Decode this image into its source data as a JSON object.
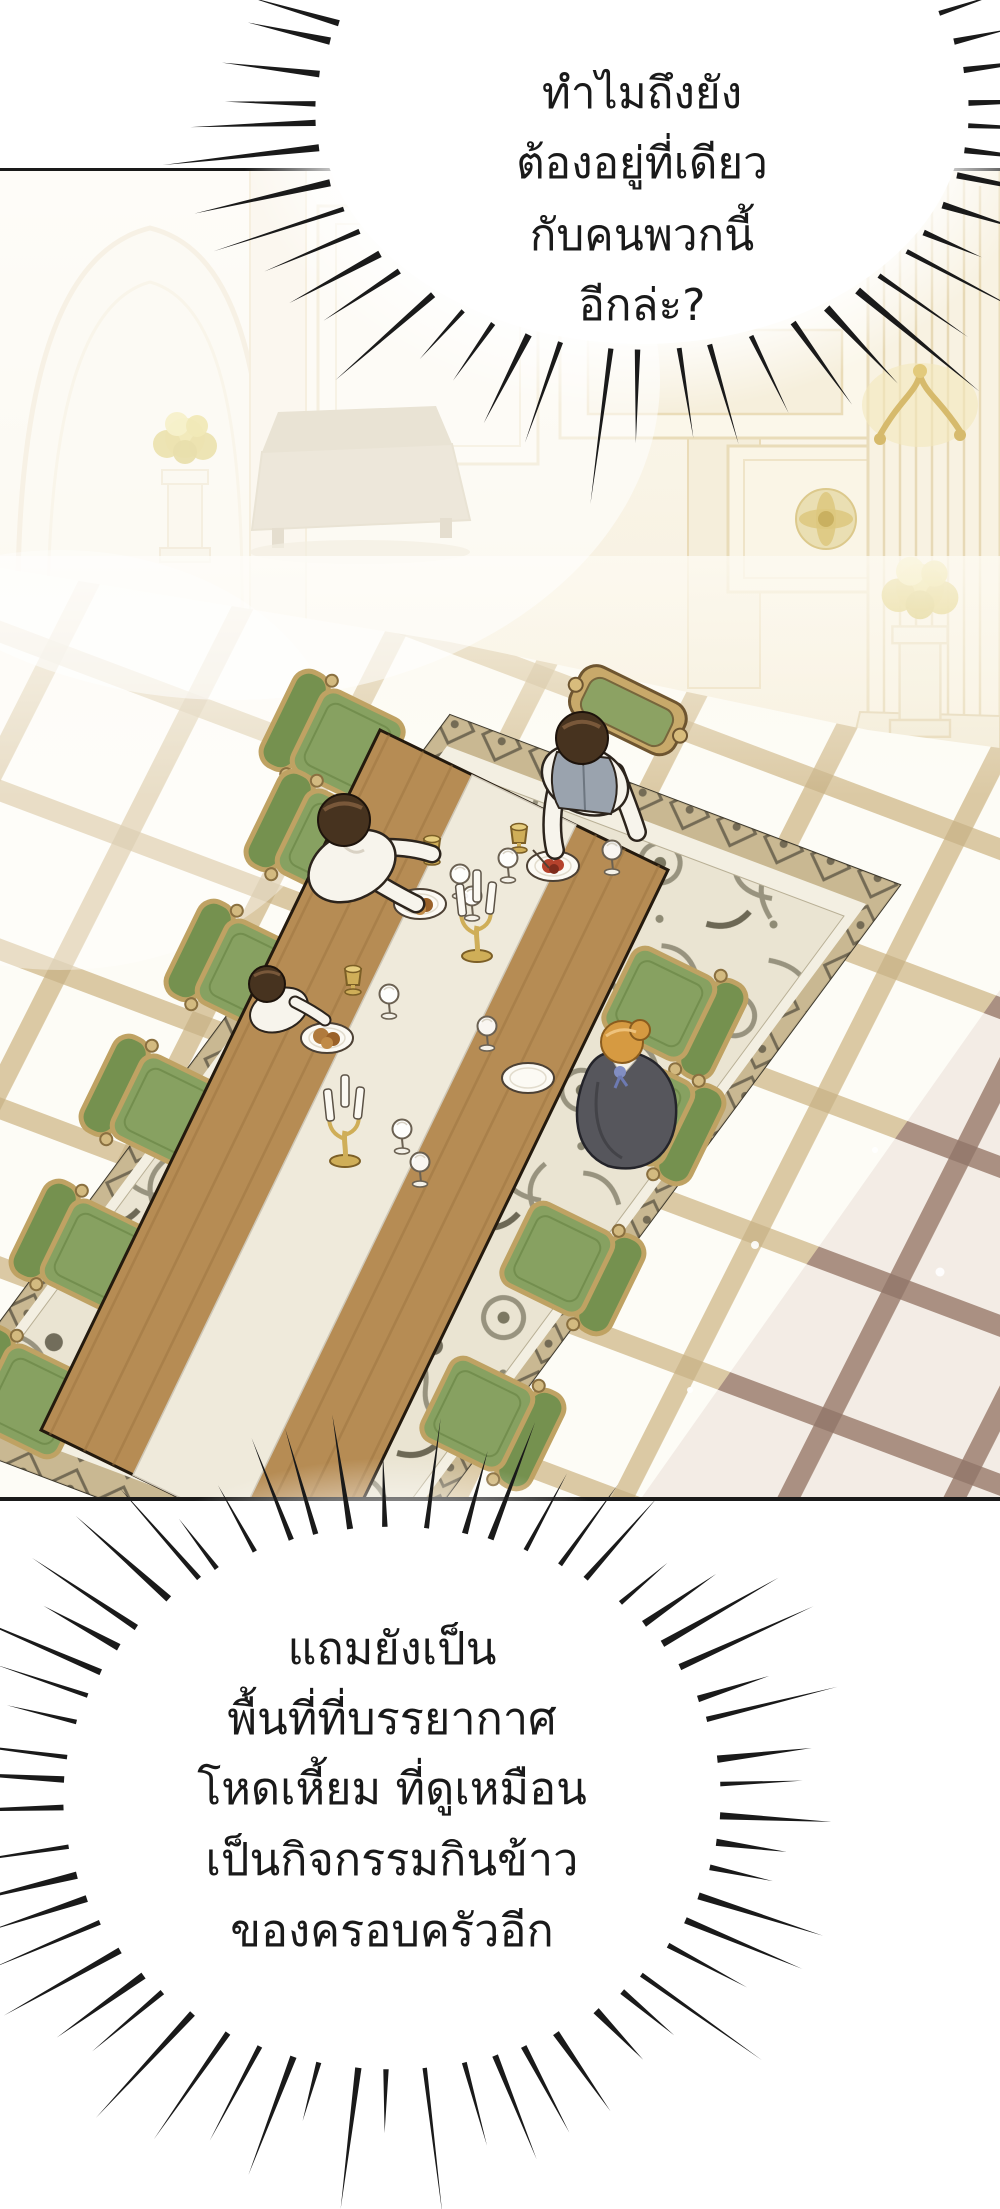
{
  "comic": {
    "type": "webtoon-panel",
    "bubbles": {
      "top": {
        "style": "burst",
        "lines": [
          "ทำไมถึงยัง",
          "ต้องอยู่ที่เดียว",
          "กับคนพวกนี้",
          "อีกล่ะ?"
        ]
      },
      "bottom": {
        "style": "burst",
        "lines": [
          "แถมยังเป็น",
          "พื้นที่ที่บรรยากาศ",
          "โหดเหี้ยม ที่ดูเหมือน",
          "เป็นกิจกรรมกินข้าว",
          "ของครอบครัวอีก"
        ]
      }
    },
    "scene": {
      "people": [
        "man-head-of-table",
        "man-left-side",
        "child-left-side",
        "woman-right-side"
      ]
    }
  },
  "colors": {
    "ink": "#1a1a1a",
    "grout": "#d7c49c",
    "grout_shadow": "#a78d80",
    "floor_base": "#fdfcf6",
    "wood": "#b68c54",
    "runner": "#efeadb",
    "chair_green": "#87a161",
    "chair_green_dark": "#75914f",
    "chair_frame": "#bfa263",
    "carpet_border_bg": "#c9b892",
    "carpet_field": "#eae4d2",
    "hair_dark": "#47331f",
    "hair_blonde": "#d69a41",
    "vest": "#9aa3ae",
    "dress": "#56565c",
    "gold": "#cfae58",
    "food_bread": "#b07a3c",
    "food_red": "#b5422c",
    "flower_yellow": "#e0cf62"
  }
}
